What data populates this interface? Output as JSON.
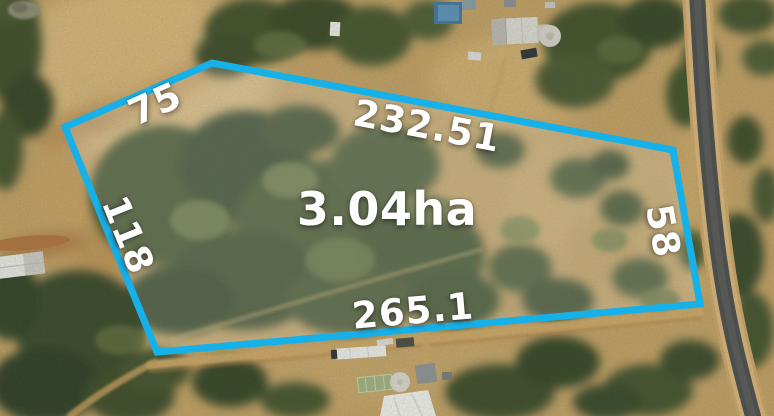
{
  "parcel": {
    "area_label": "3.04ha",
    "boundary_color": "#17b1e9",
    "boundary_fill": "rgba(245,248,250,0.16)",
    "measurements": [
      {
        "side": "upper-left",
        "label": "75"
      },
      {
        "side": "top",
        "label": "232.51"
      },
      {
        "side": "left",
        "label": "118"
      },
      {
        "side": "right",
        "label": "58"
      },
      {
        "side": "bottom",
        "label": "265.1"
      }
    ]
  },
  "scene": {
    "type": "aerial-photograph",
    "features": [
      "bushland-trees",
      "dirt-tracks",
      "sealed-road",
      "rural-buildings",
      "water-tanks"
    ]
  }
}
